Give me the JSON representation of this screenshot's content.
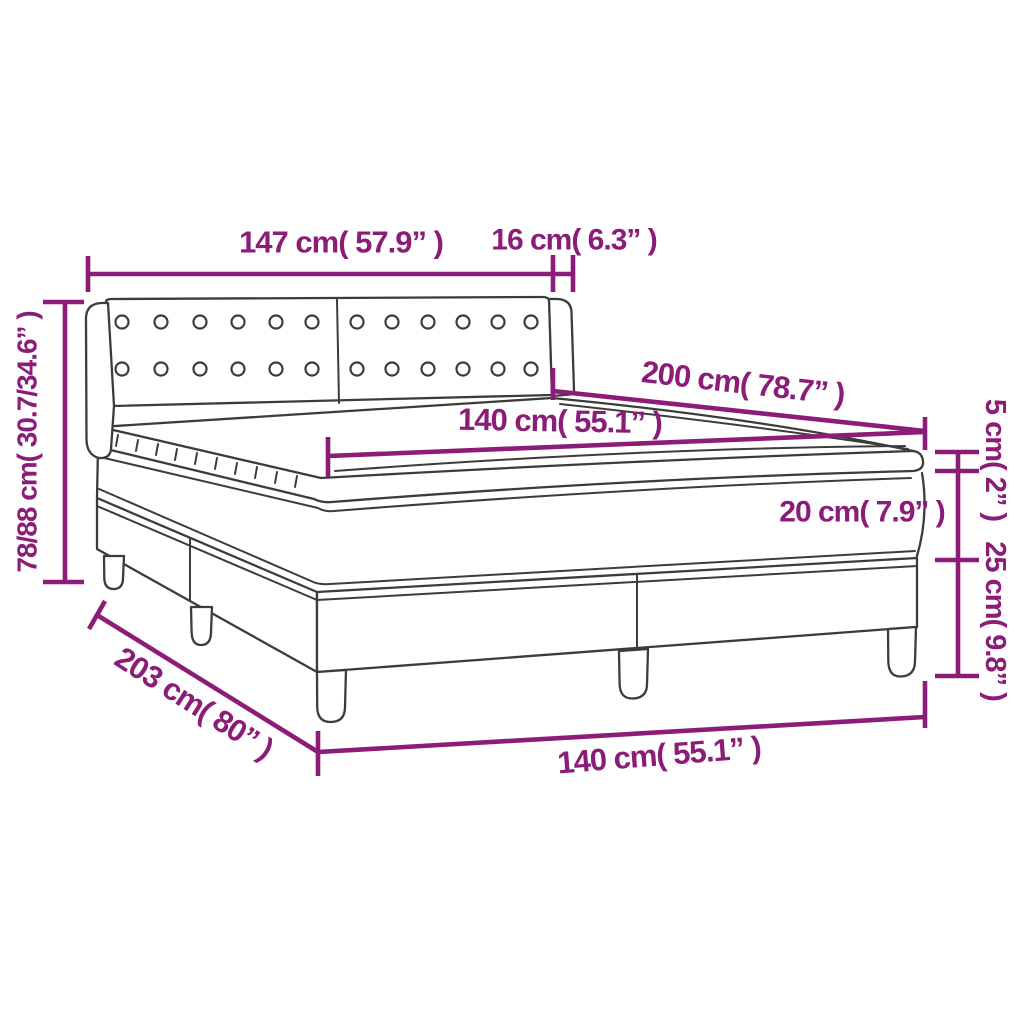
{
  "diagram": {
    "colors": {
      "dimension_lines": "#8B1C77",
      "drawing_outline": "#3C3C3B",
      "background": "#FFFFFF"
    },
    "labels": {
      "headboard_width": "147 cm( 57.9” )",
      "headboard_wing_depth": "16 cm( 6.3” )",
      "total_height": "78/88 cm( 30.7/34.6” )",
      "mattress_length": "200 cm( 78.7” )",
      "mattress_width": "140 cm( 55.1” )",
      "topper_height": "5 cm( 2” )",
      "mattress_height": "20 cm( 7.9” )",
      "base_height": "25 cm( 9.8” )",
      "bed_length": "203 cm( 80” )",
      "bed_width": "140 cm( 55.1” )"
    }
  }
}
